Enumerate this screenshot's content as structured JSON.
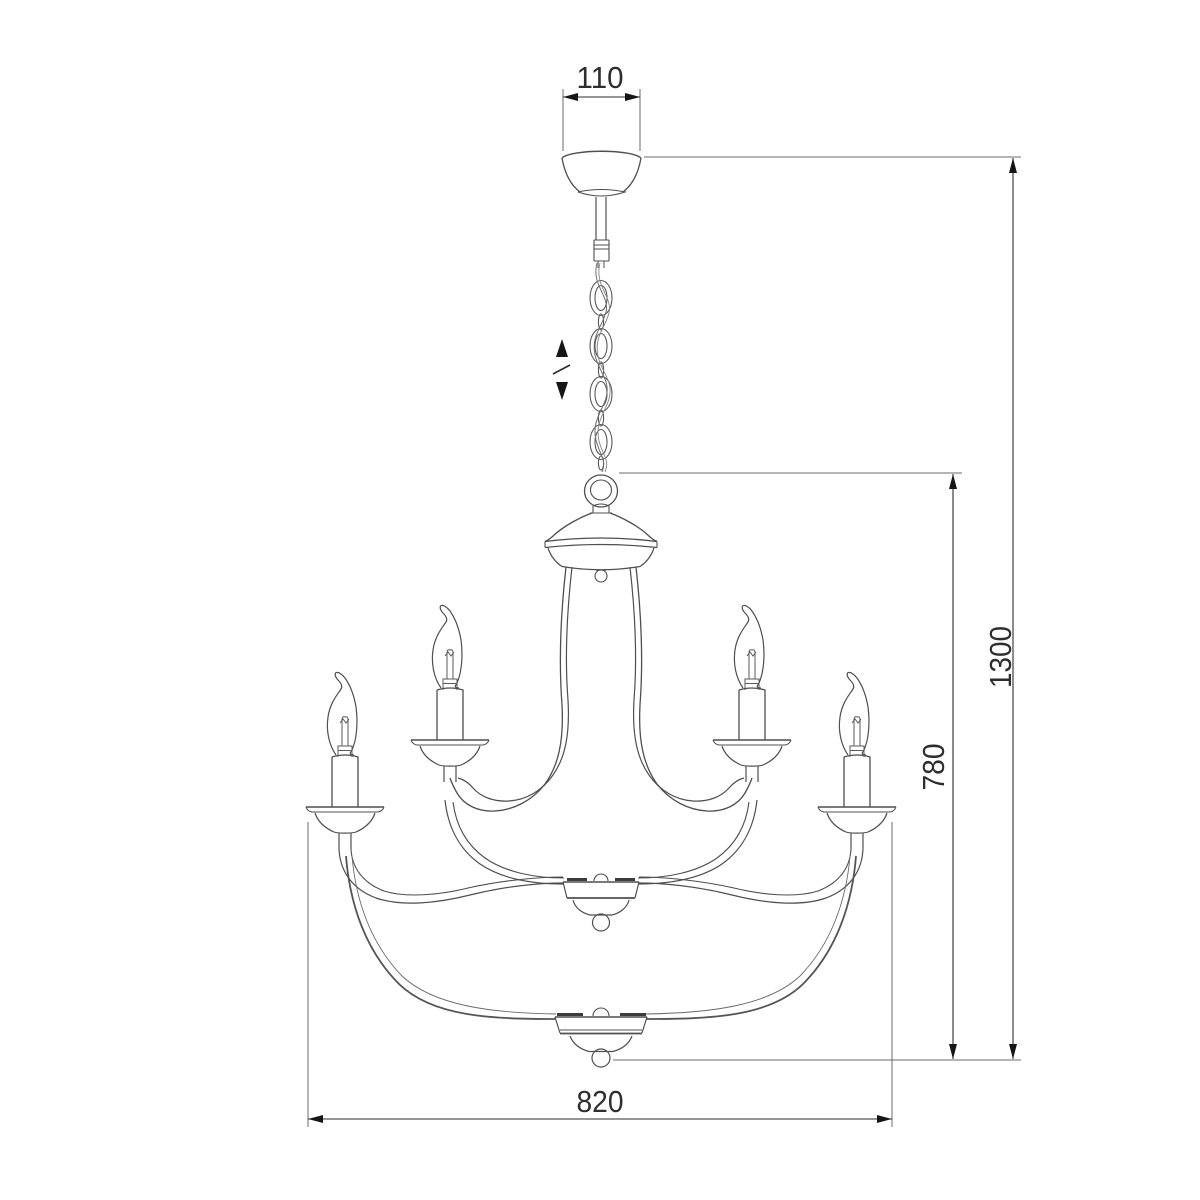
{
  "drawing": {
    "title": "chandelier-dimension-drawing",
    "colors": {
      "background": "#ffffff",
      "fixture_line": "#4f4f4f",
      "dimension_line": "#2e2e2e",
      "extension_line": "#6b6b6b",
      "arrow_fill": "#161616",
      "text": "#2e2e2e"
    },
    "icons": {
      "chain_adjust": "vertical-double-arrow-with-slash"
    },
    "dimensions": {
      "canopy_width": "110",
      "overall_height": "1300",
      "fixture_height": "780",
      "fixture_width": "820"
    }
  }
}
